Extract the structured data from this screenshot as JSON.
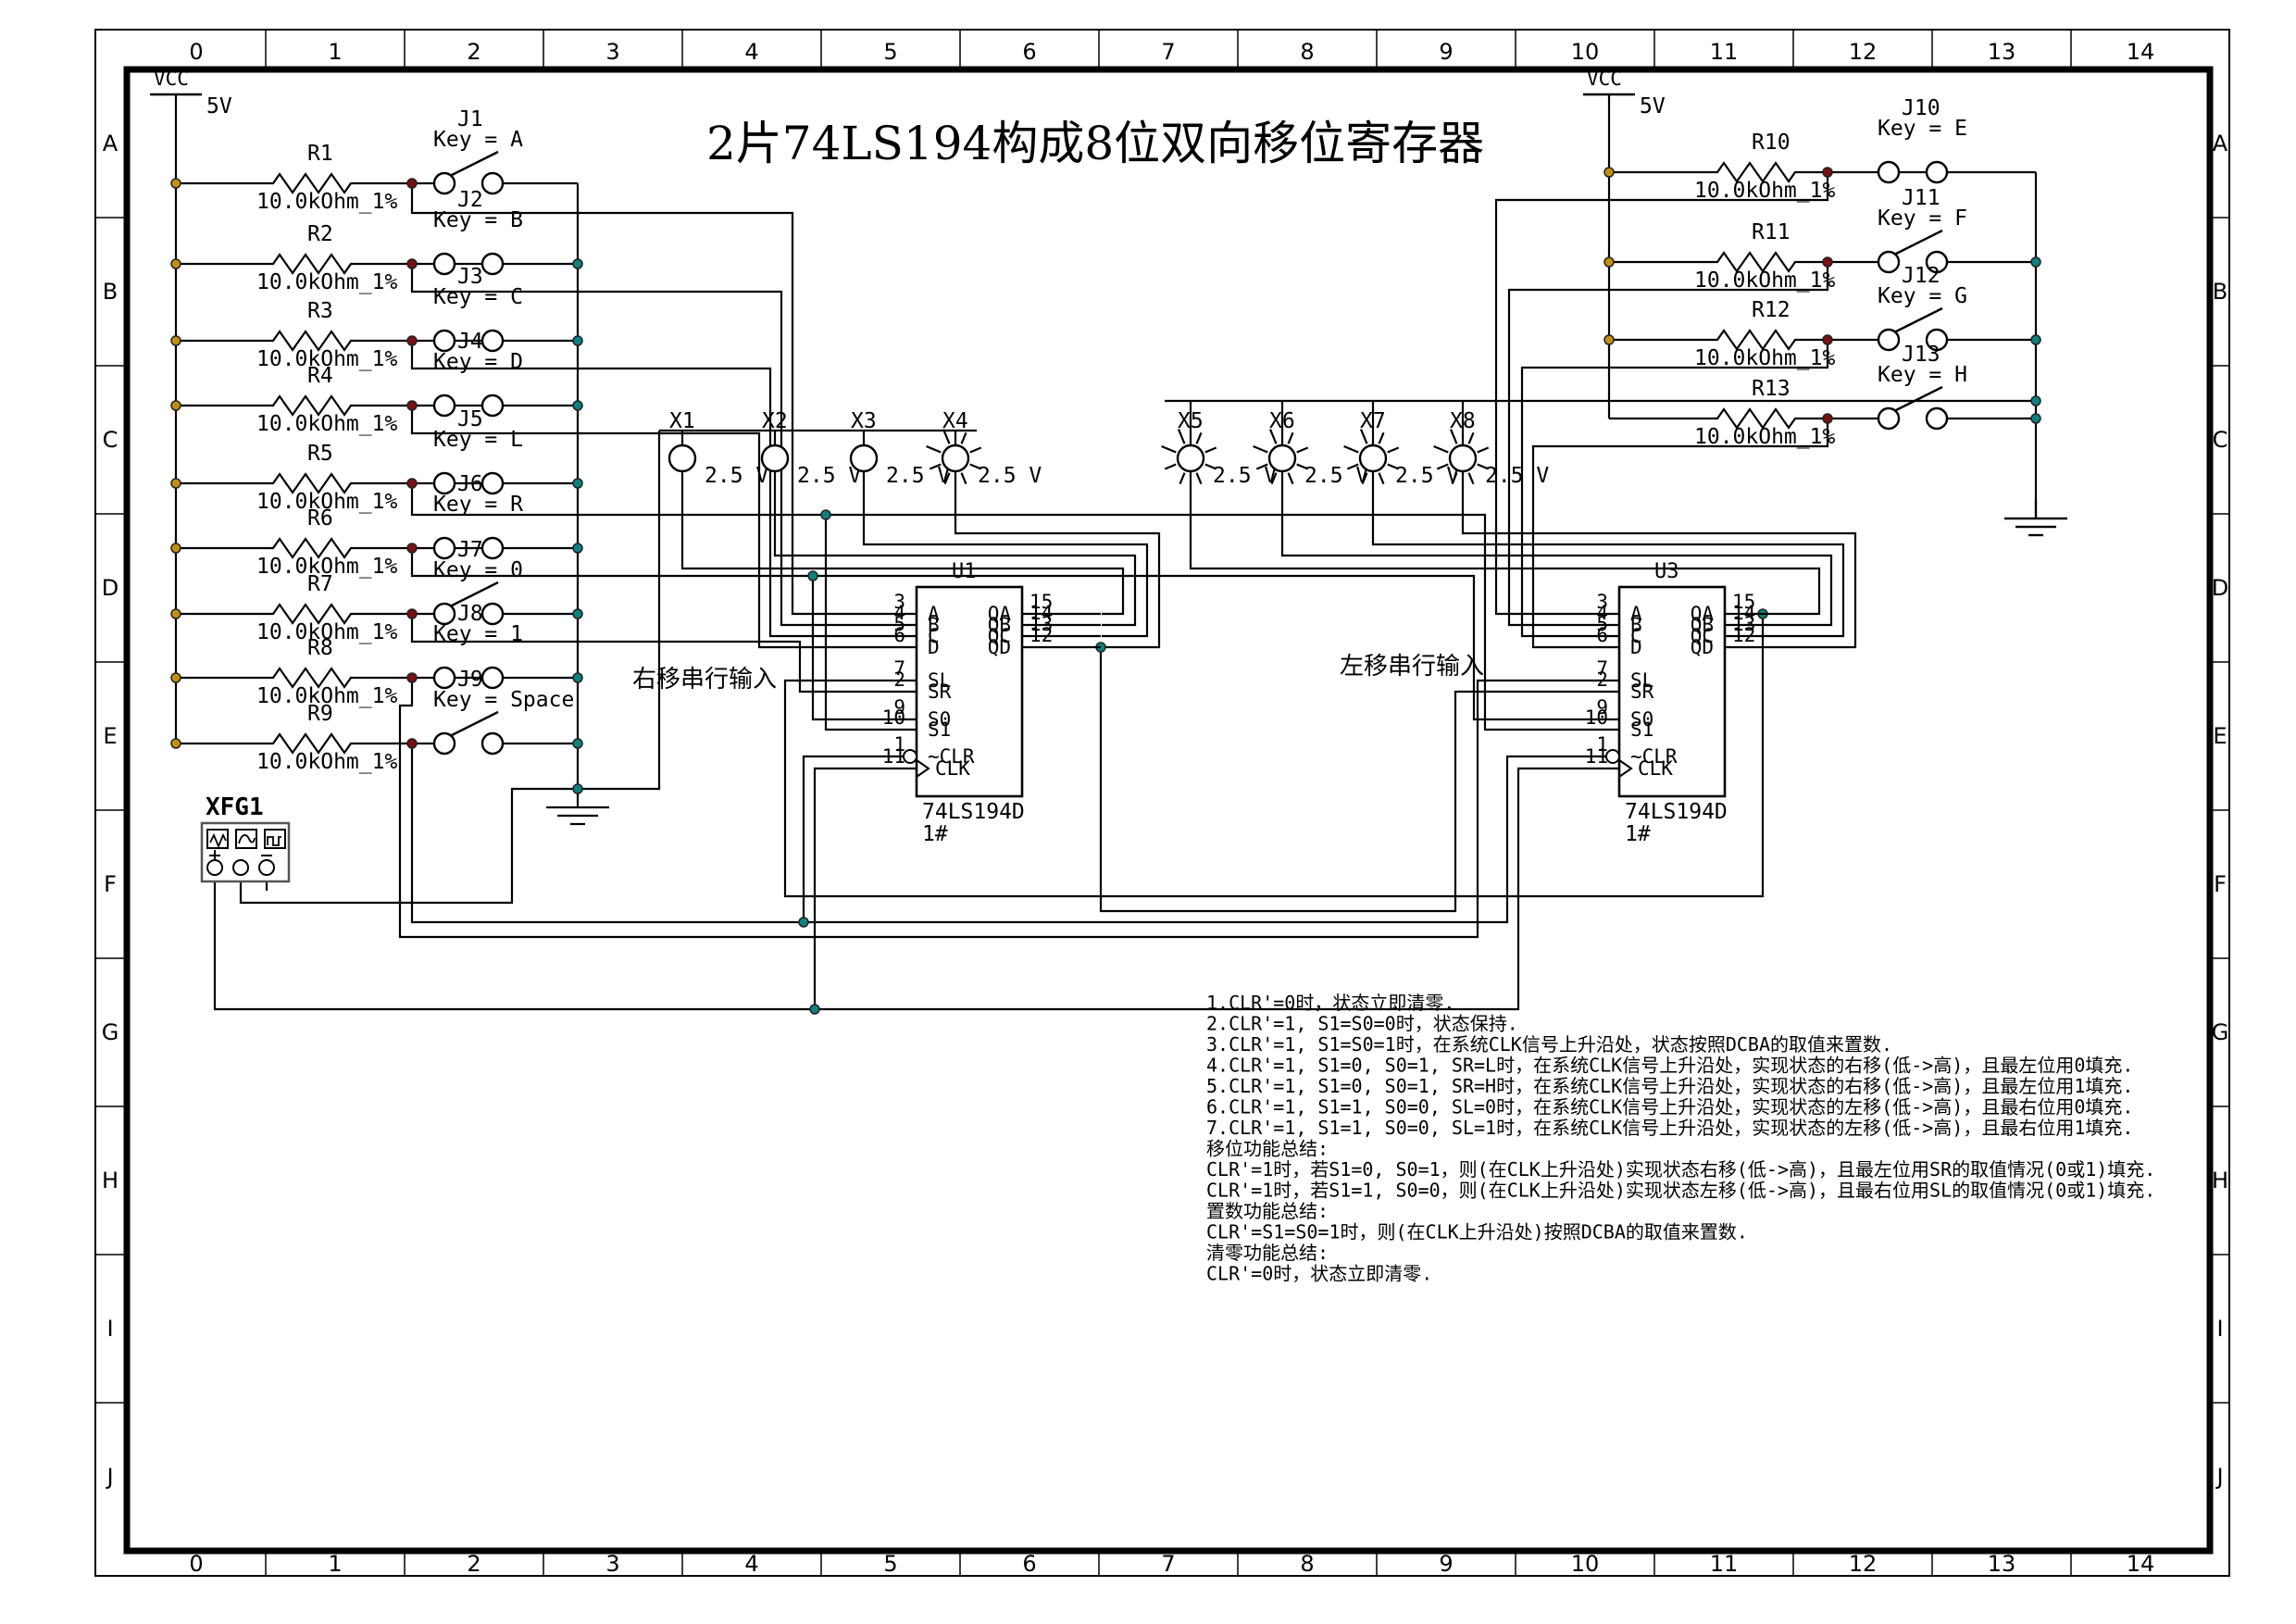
{
  "title": "2片74LS194构成8位双向移位寄存器",
  "border": {
    "columns": [
      "0",
      "1",
      "2",
      "3",
      "4",
      "5",
      "6",
      "7",
      "8",
      "9",
      "10",
      "11",
      "12",
      "13",
      "14"
    ],
    "rows": [
      "A",
      "B",
      "C",
      "D",
      "E",
      "F",
      "G",
      "H",
      "I",
      "J"
    ]
  },
  "power": {
    "vcc_left": {
      "label": "VCC",
      "voltage": "5V"
    },
    "vcc_right": {
      "label": "VCC",
      "voltage": "5V"
    }
  },
  "resistors": [
    {
      "name": "R1",
      "value": "10.0kOhm_1%"
    },
    {
      "name": "R2",
      "value": "10.0kOhm_1%"
    },
    {
      "name": "R3",
      "value": "10.0kOhm_1%"
    },
    {
      "name": "R4",
      "value": "10.0kOhm_1%"
    },
    {
      "name": "R5",
      "value": "10.0kOhm_1%"
    },
    {
      "name": "R6",
      "value": "10.0kOhm_1%"
    },
    {
      "name": "R7",
      "value": "10.0kOhm_1%"
    },
    {
      "name": "R8",
      "value": "10.0kOhm_1%"
    },
    {
      "name": "R9",
      "value": "10.0kOhm_1%"
    },
    {
      "name": "R10",
      "value": "10.0kOhm_1%"
    },
    {
      "name": "R11",
      "value": "10.0kOhm_1%"
    },
    {
      "name": "R12",
      "value": "10.0kOhm_1%"
    },
    {
      "name": "R13",
      "value": "10.0kOhm_1%"
    }
  ],
  "switches": [
    {
      "name": "J1",
      "key": "Key = A",
      "closed": false
    },
    {
      "name": "J2",
      "key": "Key = B",
      "closed": true
    },
    {
      "name": "J3",
      "key": "Key = C",
      "closed": true
    },
    {
      "name": "J4",
      "key": "Key = D",
      "closed": true
    },
    {
      "name": "J5",
      "key": "Key = L",
      "closed": true
    },
    {
      "name": "J6",
      "key": "Key = R",
      "closed": true
    },
    {
      "name": "J7",
      "key": "Key = 0",
      "closed": false
    },
    {
      "name": "J8",
      "key": "Key = 1",
      "closed": true
    },
    {
      "name": "J9",
      "key": "Key = Space",
      "closed": false
    },
    {
      "name": "J10",
      "key": "Key = E",
      "closed": true
    },
    {
      "name": "J11",
      "key": "Key = F",
      "closed": false
    },
    {
      "name": "J12",
      "key": "Key = G",
      "closed": false
    },
    {
      "name": "J13",
      "key": "Key = H",
      "closed": false
    }
  ],
  "lamps": [
    {
      "name": "X1",
      "voltage": "2.5 V",
      "lit": false
    },
    {
      "name": "X2",
      "voltage": "2.5 V",
      "lit": false
    },
    {
      "name": "X3",
      "voltage": "2.5 V",
      "lit": false
    },
    {
      "name": "X4",
      "voltage": "2.5 V",
      "lit": true
    },
    {
      "name": "X5",
      "voltage": "2.5 V",
      "lit": true
    },
    {
      "name": "X6",
      "voltage": "2.5 V",
      "lit": true
    },
    {
      "name": "X7",
      "voltage": "2.5 V",
      "lit": true
    },
    {
      "name": "X8",
      "voltage": "2.5 V",
      "lit": true
    }
  ],
  "chips": [
    {
      "refdes": "U1",
      "part": "74LS194D",
      "variant": "1#",
      "left_pins": [
        {
          "num": "3",
          "name": "A"
        },
        {
          "num": "4",
          "name": "B"
        },
        {
          "num": "5",
          "name": "C"
        },
        {
          "num": "6",
          "name": "D"
        },
        {
          "num": "7",
          "name": "SL"
        },
        {
          "num": "2",
          "name": "SR"
        },
        {
          "num": "9",
          "name": "S0"
        },
        {
          "num": "10",
          "name": "S1"
        },
        {
          "num": "1",
          "name": "~CLR"
        },
        {
          "num": "11",
          "name": "CLK"
        }
      ],
      "right_pins": [
        {
          "num": "15",
          "name": "QA"
        },
        {
          "num": "14",
          "name": "QB"
        },
        {
          "num": "13",
          "name": "QC"
        },
        {
          "num": "12",
          "name": "QD"
        }
      ]
    },
    {
      "refdes": "U3",
      "part": "74LS194D",
      "variant": "1#",
      "left_pins": [
        {
          "num": "3",
          "name": "A"
        },
        {
          "num": "4",
          "name": "B"
        },
        {
          "num": "5",
          "name": "C"
        },
        {
          "num": "6",
          "name": "D"
        },
        {
          "num": "7",
          "name": "SL"
        },
        {
          "num": "2",
          "name": "SR"
        },
        {
          "num": "9",
          "name": "S0"
        },
        {
          "num": "10",
          "name": "S1"
        },
        {
          "num": "1",
          "name": "~CLR"
        },
        {
          "num": "11",
          "name": "CLK"
        }
      ],
      "right_pins": [
        {
          "num": "15",
          "name": "QA"
        },
        {
          "num": "14",
          "name": "QB"
        },
        {
          "num": "13",
          "name": "QC"
        },
        {
          "num": "12",
          "name": "QD"
        }
      ]
    }
  ],
  "instrument": {
    "name": "XFG1",
    "plus": "+",
    "minus": "-"
  },
  "net_labels": {
    "right_shift": "右移串行输入",
    "left_shift": "左移串行输入"
  },
  "notes": [
    "1.CLR'=0时，状态立即清零.",
    "2.CLR'=1, S1=S0=0时，状态保持.",
    "3.CLR'=1, S1=S0=1时，在系统CLK信号上升沿处，状态按照DCBA的取值来置数.",
    "4.CLR'=1, S1=0, S0=1, SR=L时，在系统CLK信号上升沿处，实现状态的右移(低->高)，且最左位用0填充.",
    "5.CLR'=1, S1=0, S0=1, SR=H时，在系统CLK信号上升沿处，实现状态的右移(低->高)，且最左位用1填充.",
    "6.CLR'=1, S1=1, S0=0, SL=0时，在系统CLK信号上升沿处，实现状态的左移(低->高)，且最右位用0填充.",
    "7.CLR'=1, S1=1, S0=0, SL=1时，在系统CLK信号上升沿处，实现状态的左移(低->高)，且最右位用1填充.",
    "移位功能总结:",
    "CLR'=1时，若S1=0, S0=1，则(在CLK上升沿处)实现状态右移(低->高)，且最左位用SR的取值情况(0或1)填充.",
    "CLR'=1时，若S1=1, S0=0，则(在CLK上升沿处)实现状态左移(低->高)，且最右位用SL的取值情况(0或1)填充.",
    "置数功能总结:",
    "CLR'=S1=S0=1时，则(在CLK上升沿处)按照DCBA的取值来置数.",
    "清零功能总结:",
    "CLR'=0时，状态立即清零."
  ],
  "colors": {
    "wire": "#000000",
    "tap_dot": "#7a1010",
    "rail_dot": "#c09010",
    "bus_dot": "#0e8080"
  }
}
